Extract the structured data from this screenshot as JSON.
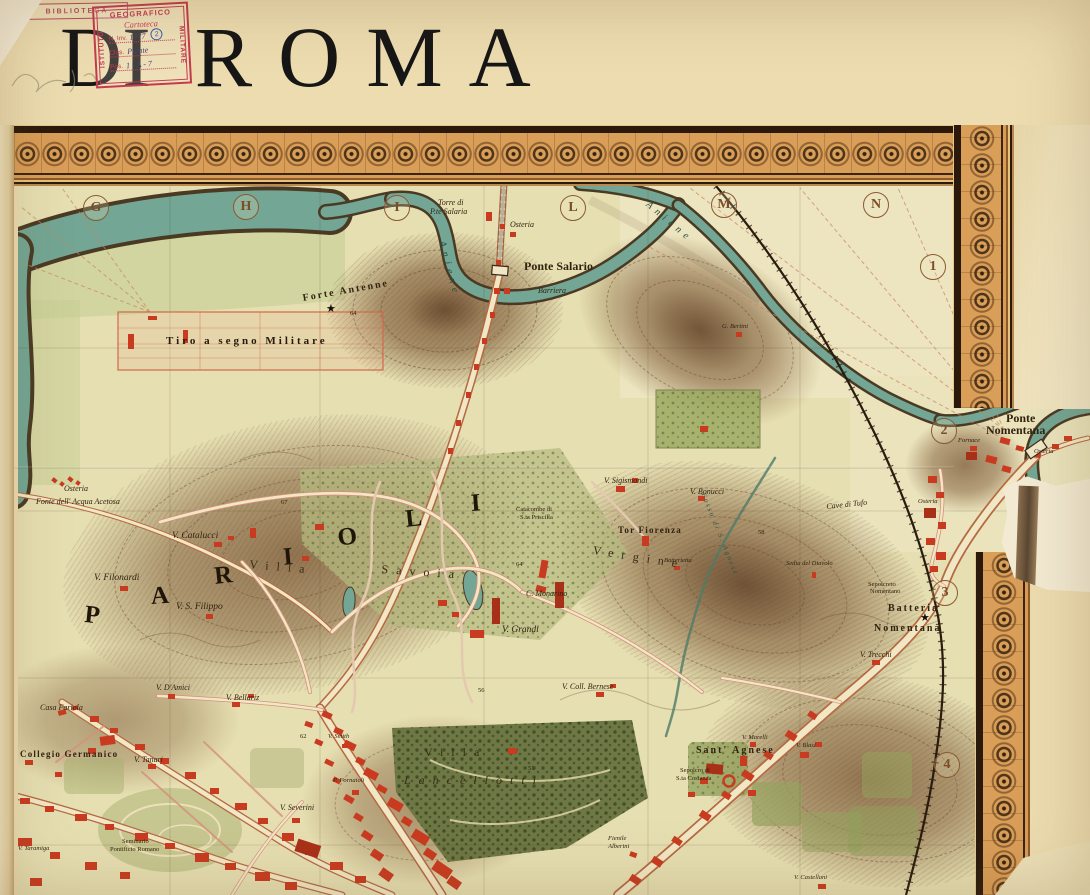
{
  "title": {
    "di": "DI",
    "roma": "ROMA"
  },
  "stamps": {
    "biblioteca": "BIBLIOTECA",
    "igm": {
      "top": "GEOGRAFICO",
      "left": "ISTITUTO",
      "right": "MILITARE",
      "script": "Cartoteca",
      "rows": [
        {
          "label": "N. Inv.",
          "value": "1777",
          "badge": "2"
        },
        {
          "label": "Clas.",
          "value": "Piante"
        },
        {
          "label": "Pos.",
          "value": "1 - A - 7"
        }
      ]
    }
  },
  "map": {
    "grid_marks": [
      {
        "ch": "G",
        "x": 95,
        "y": 207
      },
      {
        "ch": "H",
        "x": 245,
        "y": 206
      },
      {
        "ch": "I",
        "x": 396,
        "y": 207
      },
      {
        "ch": "L",
        "x": 572,
        "y": 207
      },
      {
        "ch": "M",
        "x": 723,
        "y": 204
      },
      {
        "ch": "N",
        "x": 875,
        "y": 204
      },
      {
        "ch": "1",
        "x": 932,
        "y": 266
      },
      {
        "ch": "2",
        "x": 943,
        "y": 430
      },
      {
        "ch": "3",
        "x": 944,
        "y": 592
      },
      {
        "ch": "4",
        "x": 946,
        "y": 764
      }
    ],
    "labels": [
      {
        "t": "Torre di",
        "x": 438,
        "y": 199,
        "c": "xs i"
      },
      {
        "t": "P.te Salaria",
        "x": 430,
        "y": 208,
        "c": "xs i"
      },
      {
        "t": "Osteria",
        "x": 510,
        "y": 221,
        "c": "xs i"
      },
      {
        "t": "Ponte Salario",
        "x": 524,
        "y": 260,
        "c": "md b"
      },
      {
        "t": "Barriera",
        "x": 538,
        "y": 287,
        "c": "xs i"
      },
      {
        "t": "Forte Antenne",
        "x": 302,
        "y": 294,
        "c": "spb",
        "r": -10
      },
      {
        "t": "★",
        "x": 326,
        "y": 304,
        "c": "star"
      },
      {
        "t": "64",
        "x": 350,
        "y": 311,
        "c": "xxs"
      },
      {
        "t": "Tiro a segno Militare",
        "x": 166,
        "y": 336,
        "c": "tiro"
      },
      {
        "t": "Aniene",
        "x": 446,
        "y": 240,
        "c": "riv",
        "r": 75
      },
      {
        "t": "Aniene",
        "x": 650,
        "y": 200,
        "c": "riv",
        "r": 40
      },
      {
        "t": "Osteria",
        "x": 64,
        "y": 485,
        "c": "xs i"
      },
      {
        "t": "Fonte dell' Acqua Acetosa",
        "x": 36,
        "y": 498,
        "c": "xs i"
      },
      {
        "t": "V. Catalucci",
        "x": 172,
        "y": 532,
        "c": "sm i"
      },
      {
        "t": "V. Filonardi",
        "x": 94,
        "y": 574,
        "c": "sm i"
      },
      {
        "t": "V. S. Filippo",
        "x": 176,
        "y": 603,
        "c": "sm i"
      },
      {
        "t": "P",
        "x": 86,
        "y": 602,
        "c": "huge",
        "r": 6
      },
      {
        "t": "A",
        "x": 150,
        "y": 584,
        "c": "huge",
        "r": -4
      },
      {
        "t": "R",
        "x": 213,
        "y": 564,
        "c": "huge",
        "r": -6
      },
      {
        "t": "I",
        "x": 282,
        "y": 545,
        "c": "huge",
        "r": -5
      },
      {
        "t": "O",
        "x": 336,
        "y": 526,
        "c": "huge",
        "r": -8
      },
      {
        "t": "L",
        "x": 404,
        "y": 507,
        "c": "huge",
        "r": -6
      },
      {
        "t": "I",
        "x": 470,
        "y": 491,
        "c": "huge",
        "r": -4
      },
      {
        "t": "Villa",
        "x": 250,
        "y": 558,
        "c": "sp2",
        "r": 5
      },
      {
        "t": "Savoia",
        "x": 382,
        "y": 563,
        "c": "sp2",
        "r": 4
      },
      {
        "t": "Catacombe di",
        "x": 516,
        "y": 507,
        "c": "xxs"
      },
      {
        "t": "S.ta Priscilla",
        "x": 520,
        "y": 515,
        "c": "xxs"
      },
      {
        "t": "C. Monarino",
        "x": 526,
        "y": 590,
        "c": "xs i"
      },
      {
        "t": "V. Grandi",
        "x": 502,
        "y": 626,
        "c": "sm i"
      },
      {
        "t": "V. Sigismondi",
        "x": 604,
        "y": 477,
        "c": "xs i"
      },
      {
        "t": "V. Bonucci",
        "x": 690,
        "y": 488,
        "c": "xs i"
      },
      {
        "t": "Tor Fiorenza",
        "x": 618,
        "y": 526,
        "c": "spb2"
      },
      {
        "t": "Vergine",
        "x": 594,
        "y": 544,
        "c": "sp2",
        "r": 9
      },
      {
        "t": "Batterietta",
        "x": 664,
        "y": 558,
        "c": "xxs i"
      },
      {
        "t": "Fosso di S. Agnese",
        "x": 706,
        "y": 492,
        "c": "riv2",
        "r": 68
      },
      {
        "t": "Sedia del Diavolo",
        "x": 786,
        "y": 561,
        "c": "xxs i"
      },
      {
        "t": "Cave di Tufo",
        "x": 826,
        "y": 503,
        "c": "xs i",
        "r": -6
      },
      {
        "t": "Osteria",
        "x": 918,
        "y": 499,
        "c": "xxs i"
      },
      {
        "t": "Fornace",
        "x": 958,
        "y": 438,
        "c": "xxs i"
      },
      {
        "t": "Osteria",
        "x": 1034,
        "y": 449,
        "c": "xxs i"
      },
      {
        "t": "Ponte",
        "x": 1006,
        "y": 412,
        "c": "md b"
      },
      {
        "t": "Nomentana",
        "x": 986,
        "y": 424,
        "c": "md b"
      },
      {
        "t": "Sepolcreto",
        "x": 868,
        "y": 582,
        "c": "xxs"
      },
      {
        "t": "Nomentano",
        "x": 870,
        "y": 589,
        "c": "xxs"
      },
      {
        "t": "Batteria",
        "x": 888,
        "y": 604,
        "c": "spb"
      },
      {
        "t": "★",
        "x": 920,
        "y": 613,
        "c": "star"
      },
      {
        "t": "Nomentana",
        "x": 874,
        "y": 624,
        "c": "spb"
      },
      {
        "t": "V. Trecchi",
        "x": 860,
        "y": 651,
        "c": "xs i"
      },
      {
        "t": "G. Bertini",
        "x": 722,
        "y": 324,
        "c": "xxs i"
      },
      {
        "t": "Sant' Agnese",
        "x": 696,
        "y": 746,
        "c": "spb"
      },
      {
        "t": "Sepolcro di",
        "x": 680,
        "y": 768,
        "c": "xxs"
      },
      {
        "t": "S.ta Costanza",
        "x": 676,
        "y": 776,
        "c": "xxs"
      },
      {
        "t": "V. Marelli",
        "x": 742,
        "y": 735,
        "c": "xxs i"
      },
      {
        "t": "V. Blasi",
        "x": 796,
        "y": 743,
        "c": "xxs i"
      },
      {
        "t": "Villa",
        "x": 424,
        "y": 746,
        "c": "sp2"
      },
      {
        "t": "Lancellotti",
        "x": 404,
        "y": 774,
        "c": "sp2 i"
      },
      {
        "t": "V. Smith",
        "x": 328,
        "y": 734,
        "c": "xxs i"
      },
      {
        "t": "P. Fornaioli",
        "x": 333,
        "y": 778,
        "c": "xxs i"
      },
      {
        "t": "V. Severini",
        "x": 280,
        "y": 804,
        "c": "xs i"
      },
      {
        "t": "Casa Fariola",
        "x": 40,
        "y": 704,
        "c": "xs i"
      },
      {
        "t": "Collegio Germanico",
        "x": 20,
        "y": 750,
        "c": "spb2"
      },
      {
        "t": "V. D'Amici",
        "x": 156,
        "y": 684,
        "c": "xs i"
      },
      {
        "t": "V. Bellariz",
        "x": 226,
        "y": 694,
        "c": "xs i"
      },
      {
        "t": "V. Tanari",
        "x": 134,
        "y": 756,
        "c": "xs i"
      },
      {
        "t": "Seminario",
        "x": 122,
        "y": 839,
        "c": "xxs"
      },
      {
        "t": "Pontificio Romano",
        "x": 110,
        "y": 847,
        "c": "xxs"
      },
      {
        "t": "V. Taramiga",
        "x": 18,
        "y": 846,
        "c": "xxs i"
      },
      {
        "t": "V. Coll. Bernese",
        "x": 562,
        "y": 683,
        "c": "xs i"
      },
      {
        "t": "Fienile",
        "x": 608,
        "y": 836,
        "c": "xxs i"
      },
      {
        "t": "Alberini",
        "x": 608,
        "y": 844,
        "c": "xxs i"
      },
      {
        "t": "V. Castellani",
        "x": 794,
        "y": 875,
        "c": "xxs i"
      },
      {
        "t": "67",
        "x": 281,
        "y": 500,
        "c": "xxs"
      },
      {
        "t": "64",
        "x": 516,
        "y": 562,
        "c": "xxs"
      },
      {
        "t": "58",
        "x": 758,
        "y": 530,
        "c": "xxs"
      },
      {
        "t": "51",
        "x": 528,
        "y": 766,
        "c": "xxs"
      },
      {
        "t": "62",
        "x": 300,
        "y": 734,
        "c": "xxs"
      },
      {
        "t": "56",
        "x": 478,
        "y": 688,
        "c": "xxs"
      }
    ],
    "colors": {
      "water": "#73a694",
      "buildings": "#c93b20",
      "frame_band": "#d99e58",
      "paper": "#ecdcb0",
      "terrain": "#7c5a38"
    }
  }
}
